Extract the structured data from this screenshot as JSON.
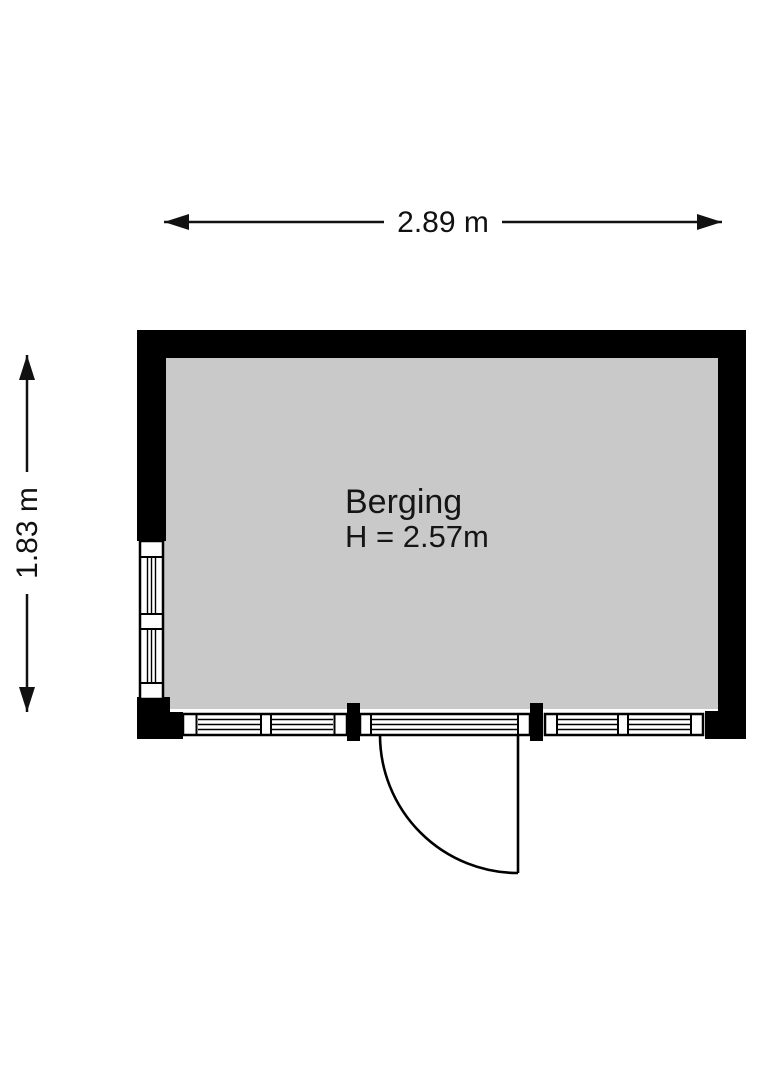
{
  "floorplan": {
    "room": {
      "name": "Berging",
      "ceiling_height_label": "H = 2.57m",
      "floor_color": "#c9c9c9",
      "wall_color": "#000000"
    },
    "dimensions": {
      "width_label": "2.89 m",
      "height_label": "1.83 m"
    }
  }
}
